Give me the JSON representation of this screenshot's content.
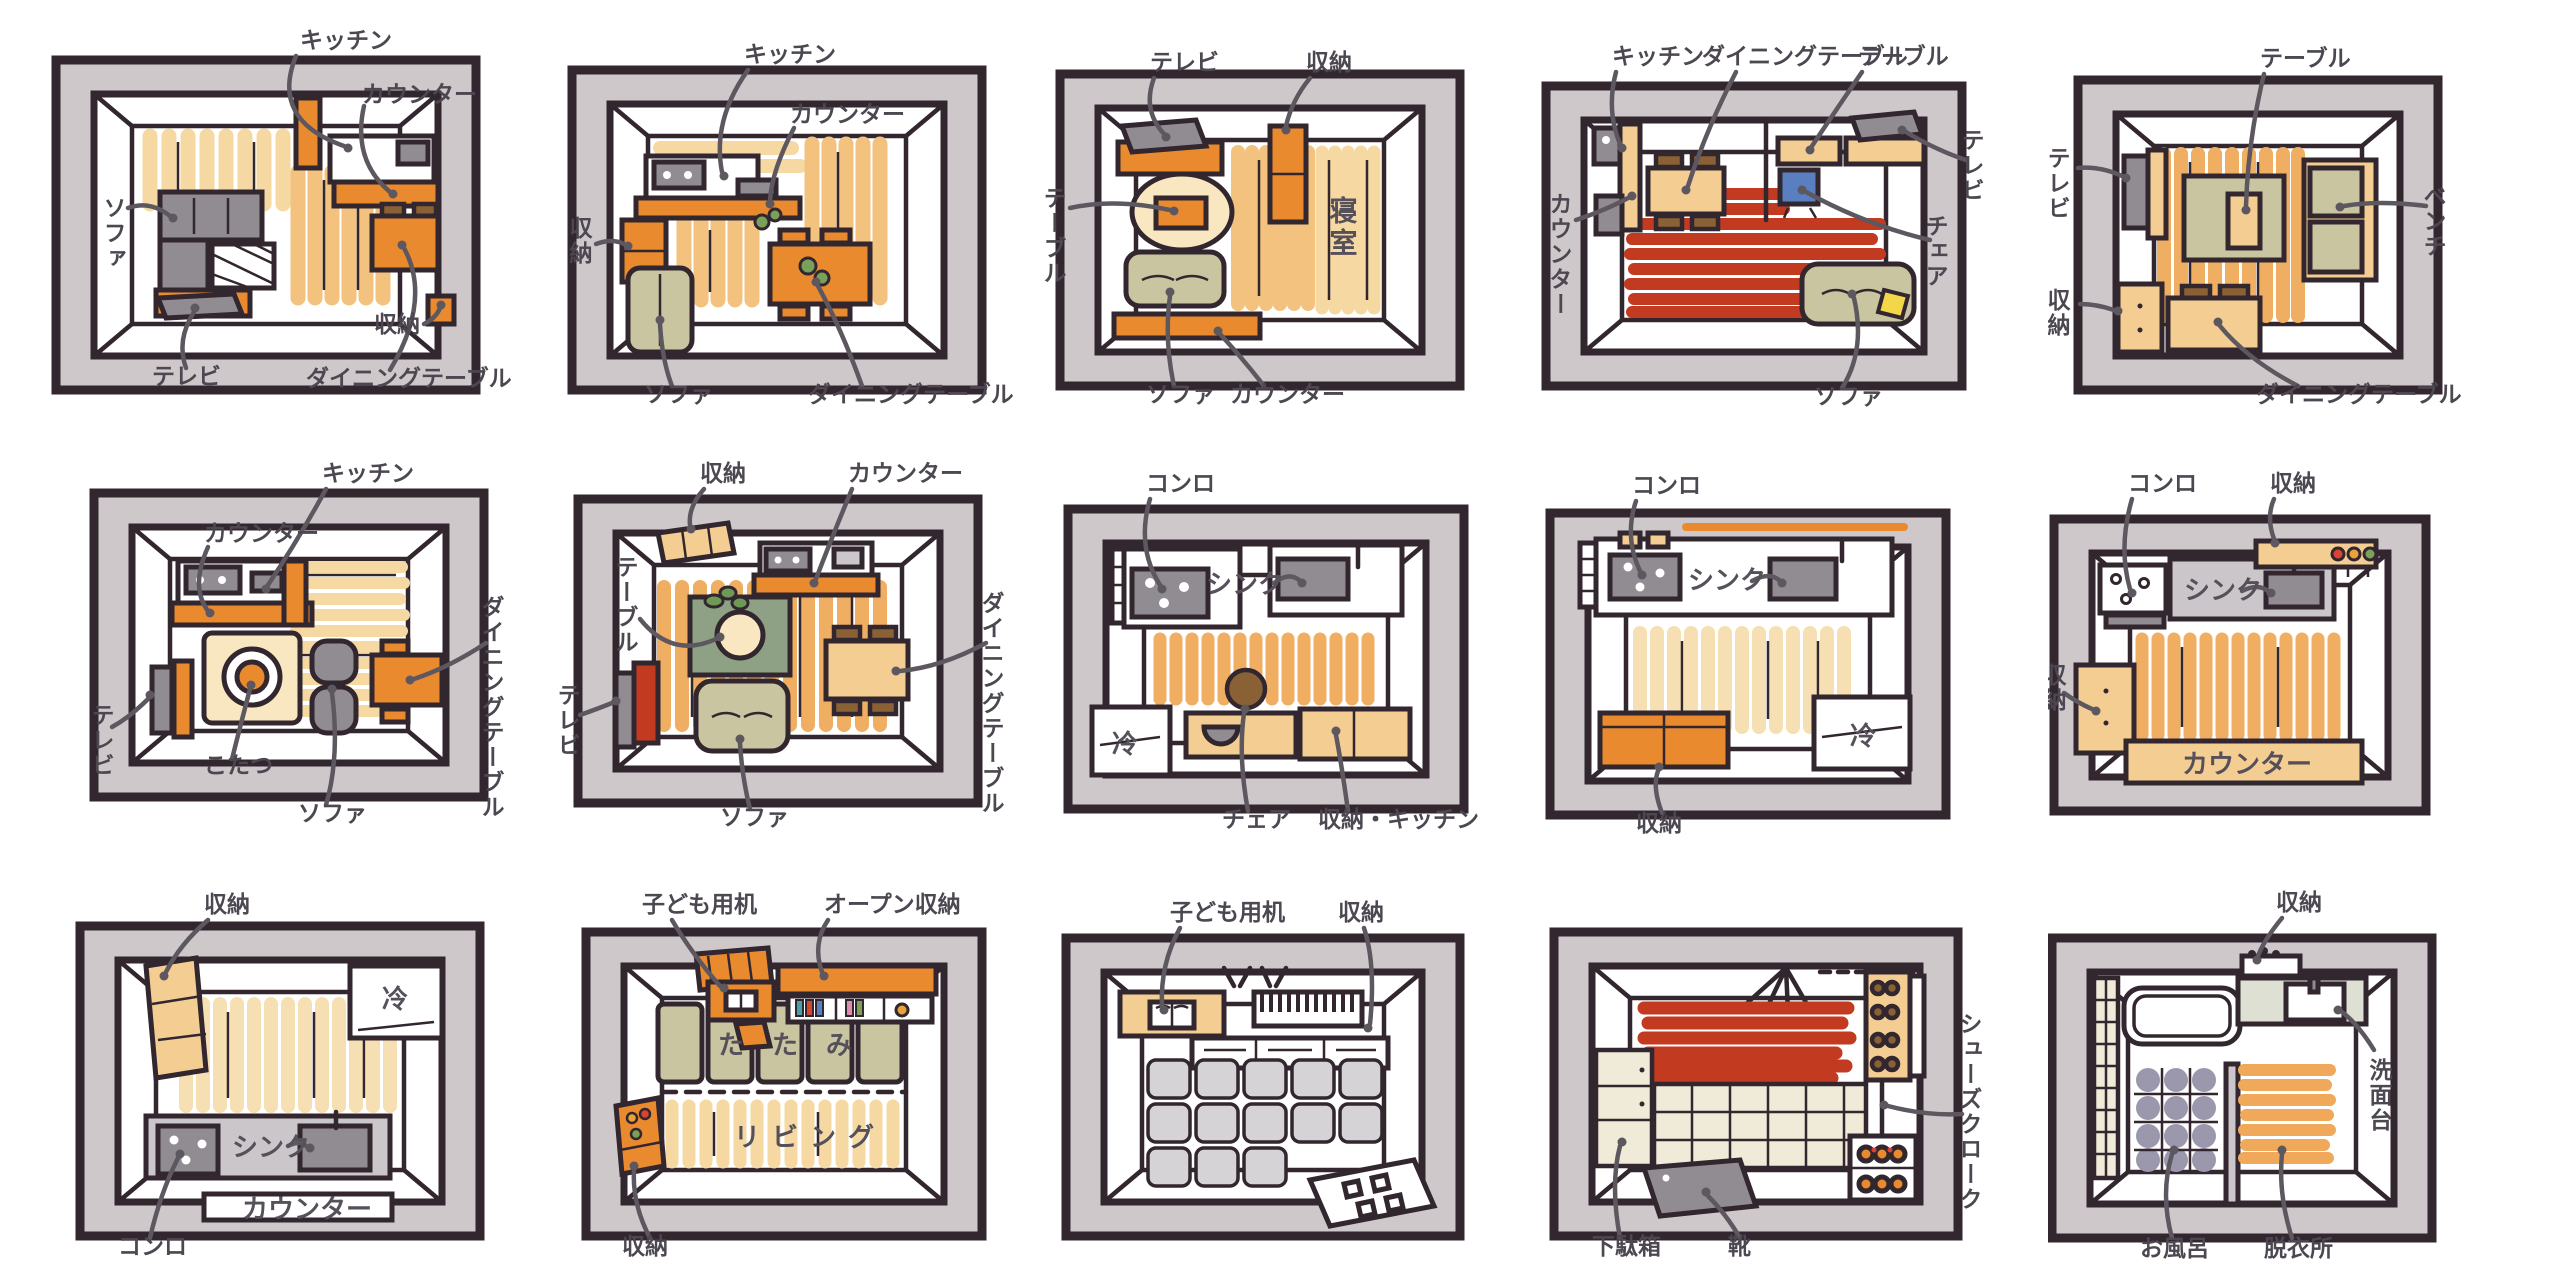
{
  "figure": {
    "description_note": "hand-drawn top-view floor plan illustrations, 3 rows x 5 columns"
  },
  "palette": {
    "outline": "#32262f",
    "wall_grey": "#cfc8cb",
    "plank_tan": "#f6d9a2",
    "plank_orange": "#f0ae62",
    "plank_cream": "#f6dfb2",
    "furniture_orange": "#e98a2f",
    "furniture_tan": "#f3cd92",
    "olive": "#c9c5a0",
    "grey": "#908c92",
    "rug_red": "#c23a20",
    "chair_blue": "#5a7fc0",
    "cushion_yellow": "#f3d64a",
    "rug_green": "#8ea184",
    "label_grey": "#4c4750"
  },
  "panels": [
    {
      "name": "living-dining-1",
      "labels": [
        {
          "id": "kitchen",
          "text": "キッチン"
        },
        {
          "id": "counter",
          "text": "カウンター"
        },
        {
          "id": "sofa",
          "text": "ソファ"
        },
        {
          "id": "tv",
          "text": "テレビ"
        },
        {
          "id": "storage",
          "text": "収納"
        },
        {
          "id": "dining-table",
          "text": "ダイニングテーブル"
        }
      ]
    },
    {
      "name": "living-dining-2",
      "labels": [
        {
          "id": "kitchen",
          "text": "キッチン"
        },
        {
          "id": "counter",
          "text": "カウンター"
        },
        {
          "id": "storage",
          "text": "収納"
        },
        {
          "id": "sofa",
          "text": "ソファ"
        },
        {
          "id": "dining-table",
          "text": "ダイニングテーブル"
        }
      ]
    },
    {
      "name": "bedroom-living",
      "labels": [
        {
          "id": "tv",
          "text": "テレビ"
        },
        {
          "id": "storage",
          "text": "収納"
        },
        {
          "id": "table",
          "text": "テーブル"
        },
        {
          "id": "bedroom",
          "text": "寝室"
        },
        {
          "id": "sofa",
          "text": "ソファ"
        },
        {
          "id": "counter",
          "text": "カウンター"
        }
      ]
    },
    {
      "name": "living-dining-red-rug",
      "labels": [
        {
          "id": "kitchen",
          "text": "キッチン"
        },
        {
          "id": "dining-table",
          "text": "ダイニングテーブル"
        },
        {
          "id": "table",
          "text": "テーブル"
        },
        {
          "id": "counter",
          "text": "カウンター"
        },
        {
          "id": "tv",
          "text": "テレビ"
        },
        {
          "id": "chair",
          "text": "チェア"
        },
        {
          "id": "sofa",
          "text": "ソファ"
        }
      ]
    },
    {
      "name": "living-bench",
      "labels": [
        {
          "id": "table",
          "text": "テーブル"
        },
        {
          "id": "bench",
          "text": "ベンチ"
        },
        {
          "id": "tv",
          "text": "テレビ"
        },
        {
          "id": "storage",
          "text": "収納"
        },
        {
          "id": "dining-table",
          "text": "ダイニングテーブル"
        }
      ]
    },
    {
      "name": "kotatsu-living",
      "labels": [
        {
          "id": "kitchen",
          "text": "キッチン"
        },
        {
          "id": "counter",
          "text": "カウンター"
        },
        {
          "id": "tv",
          "text": "テレビ"
        },
        {
          "id": "kotatsu",
          "text": "こたつ"
        },
        {
          "id": "sofa",
          "text": "ソファ"
        },
        {
          "id": "dining-table",
          "text": "ダイニングテーブル"
        }
      ]
    },
    {
      "name": "living-dining-green-rug",
      "labels": [
        {
          "id": "storage",
          "text": "収納"
        },
        {
          "id": "counter",
          "text": "カウンター"
        },
        {
          "id": "table",
          "text": "テーブル"
        },
        {
          "id": "tv",
          "text": "テレビ"
        },
        {
          "id": "sofa",
          "text": "ソファ"
        },
        {
          "id": "dining-table",
          "text": "ダイニングテーブル"
        }
      ]
    },
    {
      "name": "kitchen-galley-1",
      "labels": [
        {
          "id": "stove",
          "text": "コンロ"
        },
        {
          "id": "sink",
          "text": "シンク"
        },
        {
          "id": "fridge",
          "text": "冷"
        },
        {
          "id": "chair",
          "text": "チェア"
        },
        {
          "id": "storage-kitchen",
          "text": "収納・キッチン"
        }
      ]
    },
    {
      "name": "kitchen-galley-2",
      "labels": [
        {
          "id": "stove",
          "text": "コンロ"
        },
        {
          "id": "sink",
          "text": "シンク"
        },
        {
          "id": "fridge",
          "text": "冷"
        },
        {
          "id": "storage",
          "text": "収納"
        }
      ]
    },
    {
      "name": "kitchen-counter",
      "labels": [
        {
          "id": "stove",
          "text": "コンロ"
        },
        {
          "id": "storage-top",
          "text": "収納"
        },
        {
          "id": "sink",
          "text": "シンク"
        },
        {
          "id": "storage-left",
          "text": "収納"
        },
        {
          "id": "counter",
          "text": "カウンター"
        }
      ]
    },
    {
      "name": "kitchen-fridge",
      "labels": [
        {
          "id": "storage",
          "text": "収納"
        },
        {
          "id": "fridge",
          "text": "冷"
        },
        {
          "id": "sink",
          "text": "シンク"
        },
        {
          "id": "counter",
          "text": "カウンター"
        },
        {
          "id": "stove",
          "text": "コンロ"
        }
      ]
    },
    {
      "name": "kids-tatami-living",
      "labels": [
        {
          "id": "kids-desk",
          "text": "子ども用机"
        },
        {
          "id": "open-storage",
          "text": "オープン収納"
        },
        {
          "id": "tatami",
          "text": "たたみ"
        },
        {
          "id": "living",
          "text": "リビング"
        },
        {
          "id": "storage",
          "text": "収納"
        }
      ]
    },
    {
      "name": "kids-playroom",
      "labels": [
        {
          "id": "kids-desk",
          "text": "子ども用机"
        },
        {
          "id": "storage",
          "text": "収納"
        }
      ]
    },
    {
      "name": "entryway",
      "labels": [
        {
          "id": "shoes-cloak",
          "text": "シューズクローク"
        },
        {
          "id": "shoe-cabinet",
          "text": "下駄箱"
        },
        {
          "id": "shoes",
          "text": "靴"
        }
      ]
    },
    {
      "name": "bathroom",
      "labels": [
        {
          "id": "storage",
          "text": "収納"
        },
        {
          "id": "washstand",
          "text": "洗面台"
        },
        {
          "id": "bath",
          "text": "お風呂"
        },
        {
          "id": "dressing-room",
          "text": "脱衣所"
        }
      ]
    }
  ]
}
